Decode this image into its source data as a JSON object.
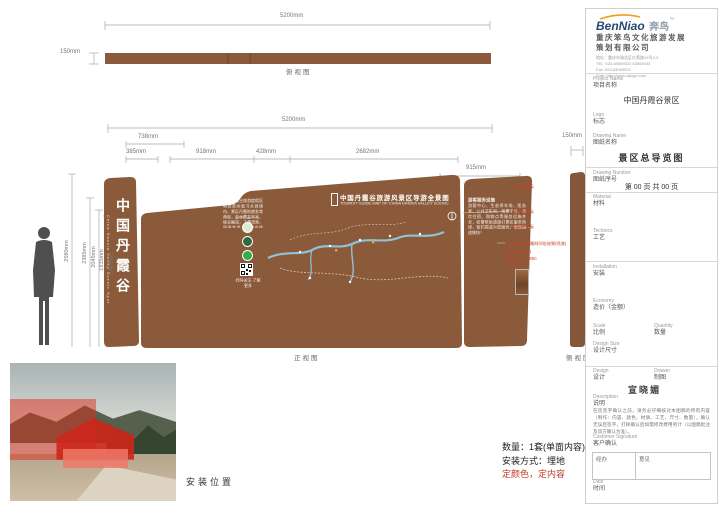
{
  "colors": {
    "board_brown": "#8a5a3a",
    "annotation_red": "#c9402e",
    "note_red": "#c0392b"
  },
  "top_view": {
    "width": "5200mm",
    "height": "150mm",
    "caption": "俯视图"
  },
  "front_view": {
    "caption": "正视图",
    "side_caption": "侧视图",
    "total_width": "5200mm",
    "seg_738": "738mm",
    "seg_385": "385mm",
    "seg_918": "918mm",
    "seg_428": "428mm",
    "seg_2682": "2682mm",
    "seg_915": "915mm",
    "side_width": "150mm",
    "heights": [
      "2580mm",
      "2385mm",
      "2045mm",
      "1935mm",
      "1860mm"
    ],
    "slab_cn": "中国丹霞谷",
    "slab_en": "China Danxia Valley Scenic Spot",
    "board_title": "中国丹霞谷旅游风景区导游全景图",
    "board_subtitle": "TOURIST GUIDE MAP OF CHINA DANXIA VALLEY SCENIC AREA",
    "intro_heading": "景区简介",
    "intro_text": "中国丹霞谷旅游度假区地处贵州省习水县境内，景区丹霞地貌发育典型，森林覆盖率高，峡谷幽深，飞瀑流泉，四季宜游，是观光揽胜、休闲度假的理想胜地。",
    "qr_caption": "扫码关注·了解更多",
    "services_heading": "游客服务设施",
    "services_text": "游客中心、生态停车场、医务室、公共卫生间、观景平台、餐饮住宿、购物点等服务设施齐全，如需帮助请拨打景区服务热线，我们竭诚为您服务。祝您旅途愉快！",
    "annotations": [
      "4mm厚钢板",
      "6mm厚钢板",
      "8mm厚钢板",
      "1.5cm厚内容雕刻凹陷效果(喷漆)",
      "表面颜色做旧",
      "PANTONE 469C",
      "(做旧处理)"
    ]
  },
  "photo": {
    "caption": "安装位置"
  },
  "notes": {
    "line1": "数量：1套(单面内容)",
    "line2": "安装方式：埋地",
    "line3": "定颜色，定内容"
  },
  "title_block": {
    "brand_name": "BenNiao",
    "brand_cn": "奔鸟",
    "brand_tm": "™",
    "company_line1": "重庆笨鸟文化旅游发展",
    "company_line2": "策划有限公司",
    "address": "地址：重庆市渝北区红黄路19号4-3",
    "tel": "TEL: 023-63069022  63069033",
    "fax": "Fax: 023-63069022",
    "web": "Web: http://www.cqlogo.com",
    "project_en": "Project Name",
    "project_cn": "项目名称",
    "project_value": "中国丹霞谷景区",
    "logo_en": "Logo",
    "logo_cn": "标志",
    "drawing_name_en": "Drawing Name",
    "drawing_name_cn": "图纸名称",
    "drawing_value": "景区总导览图",
    "drawing_no_en": "Drawing Number",
    "drawing_no_cn": "图纸序号",
    "page_text": "第  00 页    共  00 页",
    "material_en": "Material",
    "material_cn": "材料",
    "technics_en": "Technics",
    "technics_cn": "工艺",
    "install_en": "Installation",
    "install_cn": "安装",
    "economy_en": "Economy",
    "economy_cn": "造价（金额）",
    "scale_en": "Scale",
    "scale_cn": "比例",
    "quantity_en": "Quantity",
    "quantity_cn": "数量",
    "design_size_en": "Design Size",
    "design_size_cn": "设计尺寸",
    "design_en": "Design",
    "design_cn": "设计",
    "drawer_en": "Drawer",
    "drawer_cn": "制图",
    "stamp": "宣晓媚",
    "desc_en": "Description",
    "desc_cn": "说明",
    "desc_text": "在您签字确认之前，请务必仔细核对本图稿的所有内容（制作：内容、颜色、材质、工艺、尺寸、数量），确认无误后签字，打样确认后如需修改费用另计（以图稿批注及双方确认为准）。",
    "sign_en": "Customer Signature",
    "sign_cn": "客户确认",
    "cell_left": "经办",
    "cell_right": "意见",
    "date_en": "Date",
    "date_cn": "时间"
  }
}
